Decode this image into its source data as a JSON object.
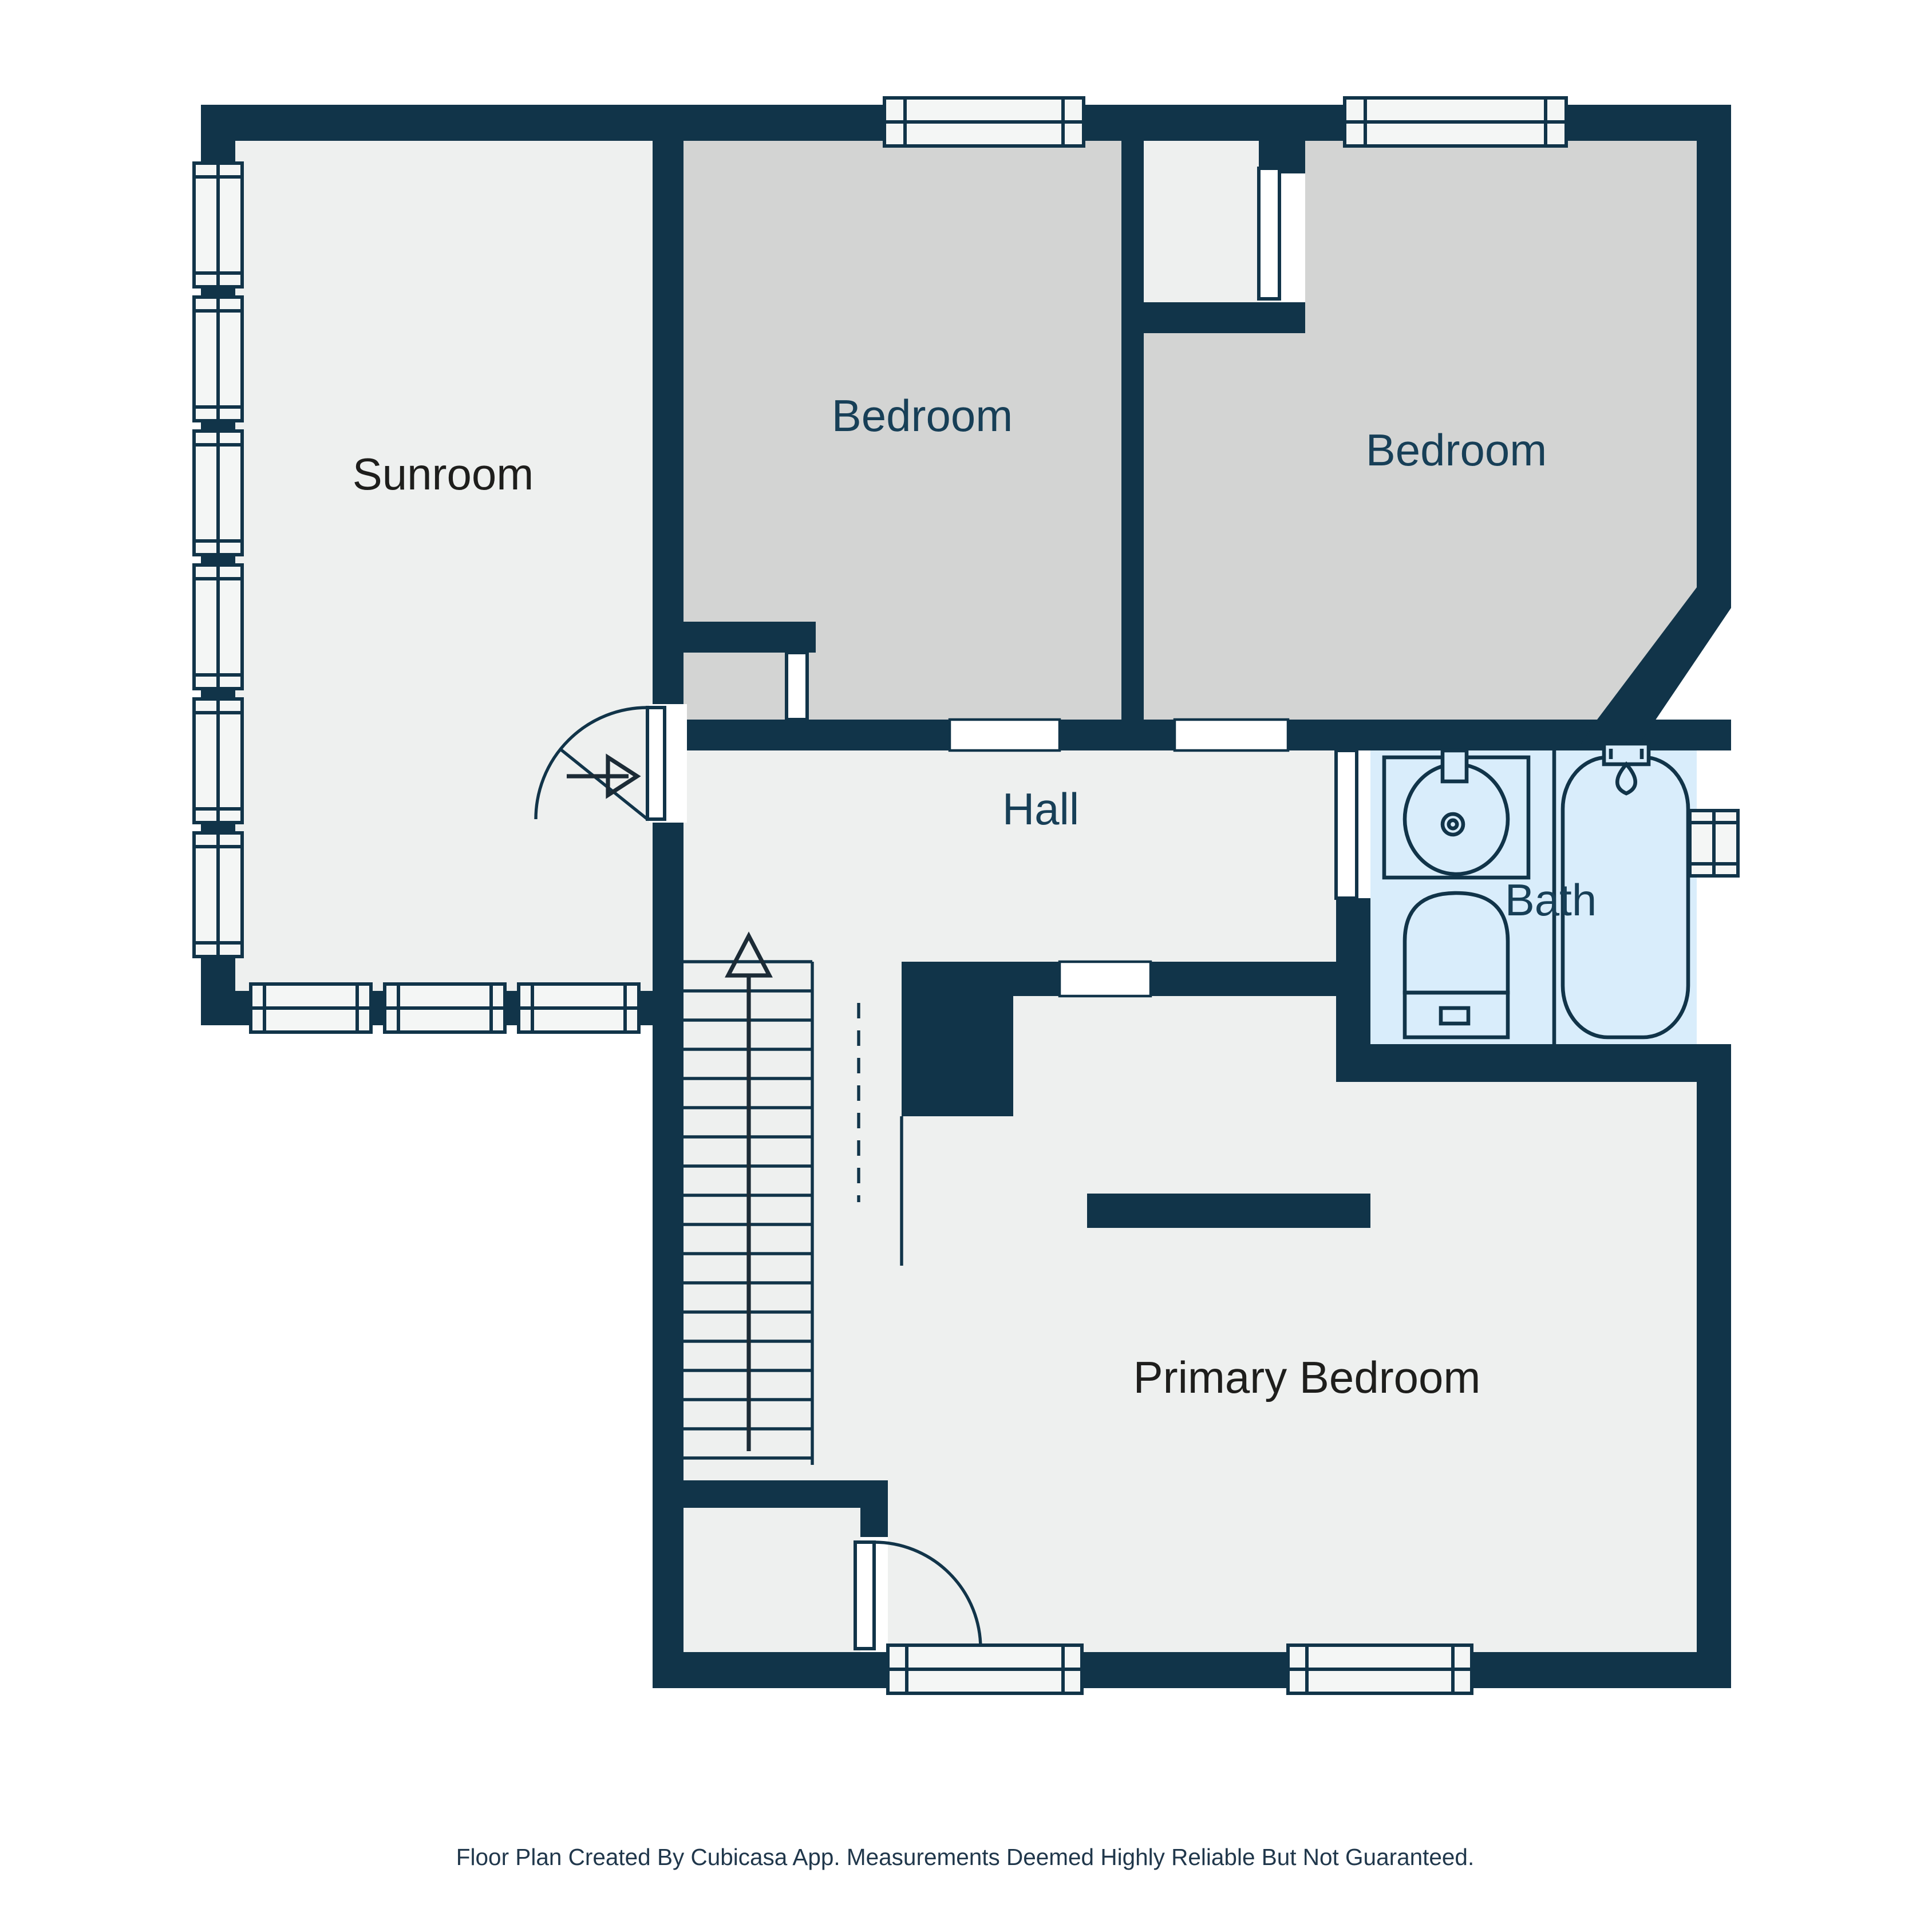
{
  "colors": {
    "wall": "#113449",
    "floor": "#eef0ef",
    "bedroom_floor": "#d3d4d3",
    "bath_floor": "#d9edfb",
    "window_fill": "#f4f6f5",
    "footer_text": "#20374b"
  },
  "rooms": {
    "sunroom": {
      "label": "Sunroom",
      "label_color": "#1e1e1c"
    },
    "bedroom_top": {
      "label": "Bedroom",
      "label_color": "#173f57"
    },
    "bedroom_right": {
      "label": "Bedroom",
      "label_color": "#173f57"
    },
    "hall": {
      "label": "Hall",
      "label_color": "#173f57"
    },
    "bath": {
      "label": "Bath",
      "label_color": "#173f57"
    },
    "primary_bedroom": {
      "label": "Primary Bedroom",
      "label_color": "#1e1e1c"
    }
  },
  "stairs": {
    "direction": "up"
  },
  "fixtures": [
    "sink",
    "toilet",
    "bathtub"
  ],
  "footer": {
    "text": "Floor Plan Created By Cubicasa App. Measurements Deemed Highly Reliable But Not Guaranteed."
  }
}
